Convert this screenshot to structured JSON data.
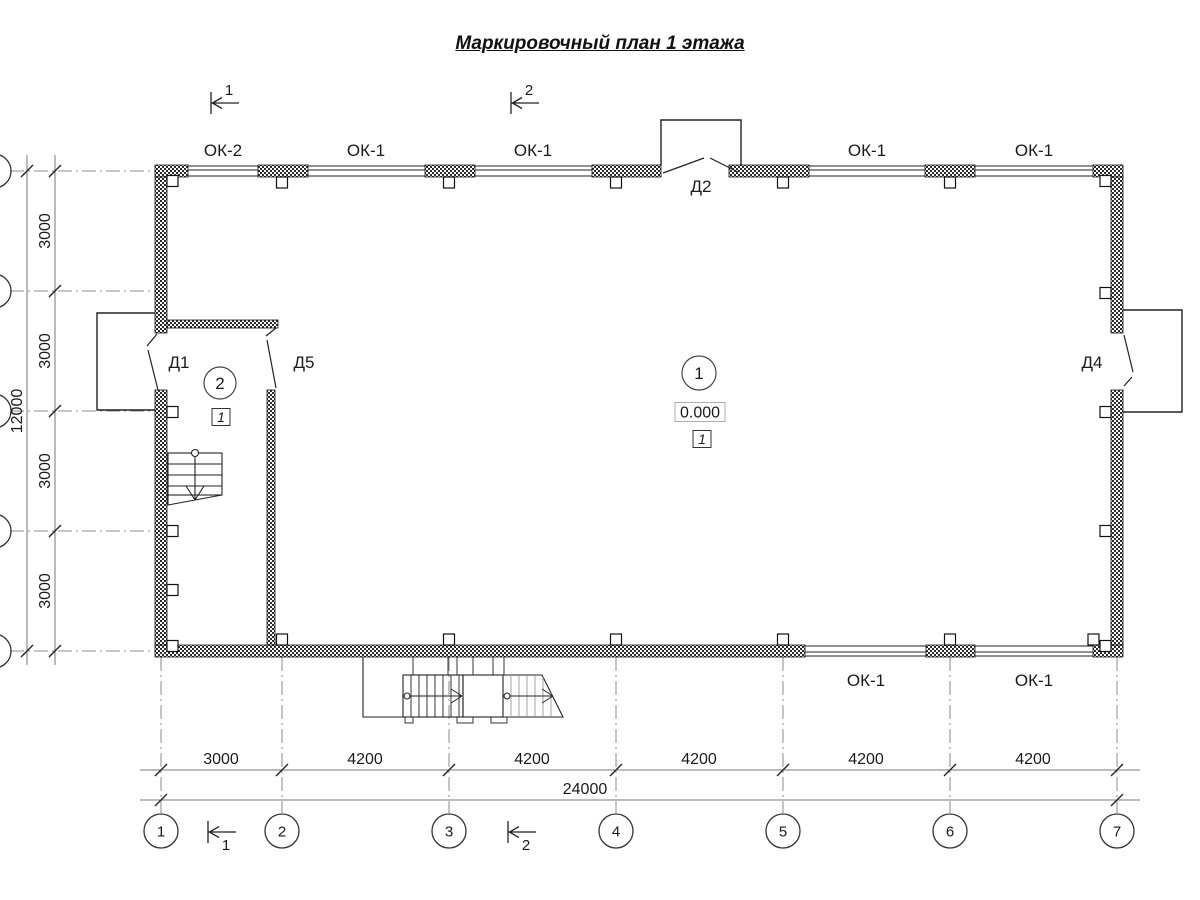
{
  "title": "Маркировочный план 1 этажа",
  "drawing": {
    "window_labels": [
      {
        "text": "ОК-2",
        "x": 223,
        "y": 156
      },
      {
        "text": "ОК-1",
        "x": 366,
        "y": 156
      },
      {
        "text": "ОК-1",
        "x": 533,
        "y": 156
      },
      {
        "text": "ОК-1",
        "x": 867,
        "y": 156
      },
      {
        "text": "ОК-1",
        "x": 1034,
        "y": 156
      },
      {
        "text": "ОК-1",
        "x": 866,
        "y": 686
      },
      {
        "text": "ОК-1",
        "x": 1034,
        "y": 686
      }
    ],
    "door_labels": [
      {
        "text": "Д2",
        "x": 701,
        "y": 192
      },
      {
        "text": "Д1",
        "x": 179,
        "y": 368
      },
      {
        "text": "Д5",
        "x": 304,
        "y": 368
      },
      {
        "text": "Д4",
        "x": 1092,
        "y": 368
      }
    ],
    "room_markers": [
      {
        "number": "1",
        "cx": 699,
        "cy": 373,
        "r": 17
      },
      {
        "number": "2",
        "cx": 220,
        "cy": 383,
        "r": 16
      }
    ],
    "elevation_mark": {
      "text": "0.000",
      "cx": 700,
      "cy": 412
    },
    "floor_marks": [
      {
        "text": "1",
        "cx": 702,
        "cy": 439
      },
      {
        "text": "1",
        "cx": 221,
        "cy": 417
      }
    ],
    "axes_bottom": {
      "labels": [
        "1",
        "2",
        "3",
        "4",
        "5",
        "6",
        "7"
      ],
      "x": [
        161,
        282,
        449,
        616,
        783,
        950,
        1117
      ],
      "cy": 831,
      "r": 17
    },
    "dims_bottom": [
      {
        "text": "3000",
        "x": 221
      },
      {
        "text": "4200",
        "x": 365
      },
      {
        "text": "4200",
        "x": 532
      },
      {
        "text": "4200",
        "x": 699
      },
      {
        "text": "4200",
        "x": 866
      },
      {
        "text": "4200",
        "x": 1033
      }
    ],
    "dims_bottom_total": {
      "text": "24000",
      "x": 585
    },
    "dims_left": [
      {
        "text": "3000",
        "y": 231
      },
      {
        "text": "3000",
        "y": 351
      },
      {
        "text": "3000",
        "y": 471
      },
      {
        "text": "3000",
        "y": 591
      }
    ],
    "dims_left_total": {
      "text": "12000",
      "y": 411
    },
    "section_marks": [
      {
        "text": "1",
        "x": 211,
        "y": 103,
        "num_above": true
      },
      {
        "text": "2",
        "x": 511,
        "y": 103,
        "num_above": true
      },
      {
        "text": "1",
        "x": 208,
        "y": 832,
        "num_above": false
      },
      {
        "text": "2",
        "x": 508,
        "y": 832,
        "num_above": false
      }
    ]
  }
}
